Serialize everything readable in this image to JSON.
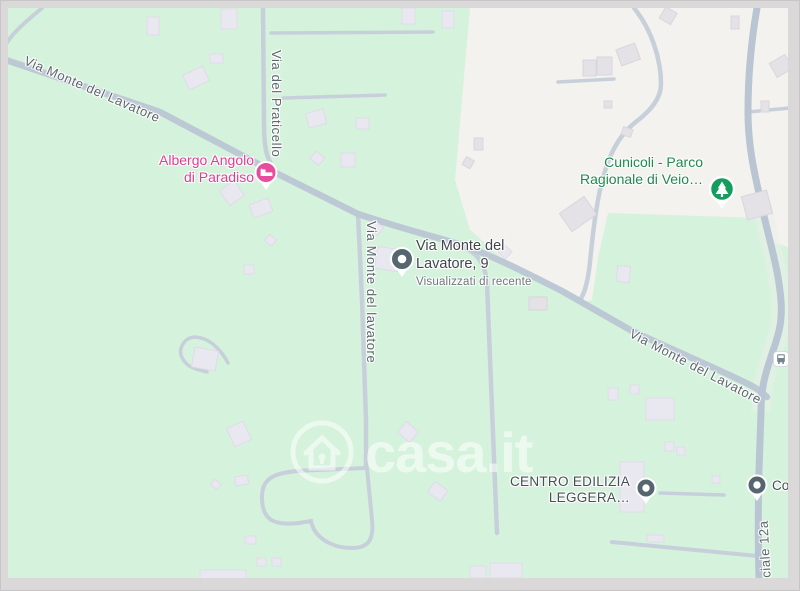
{
  "map": {
    "streets": {
      "main_nw": "Via Monte del Lavatore",
      "praticello": "Via del Praticello",
      "lavatore_vertical": "Via Monte del lavatore",
      "main_se": "Via Monte del Lavatore",
      "provinciale": "nciale 12a"
    },
    "pois": {
      "albergo": {
        "line1": "Albergo Angolo",
        "line2": "di Paradiso"
      },
      "cunicoli": {
        "line1": "Cunicoli - Parco",
        "line2": "Ragionale di Veio…"
      },
      "recent": {
        "line1": "Via Monte del",
        "line2": "Lavatore, 9",
        "note": "Visualizzati di recente"
      },
      "centro": {
        "line1": "CENTRO EDILIZIA",
        "line2": "LEGGERA…"
      },
      "cour": {
        "label": "Cour"
      }
    },
    "watermark": {
      "brand": "casa.it"
    },
    "icons": {
      "hotel": "bed-icon",
      "park": "tree-icon",
      "recent": "recent-dot-pin-icon",
      "generic": "dot-pin-icon",
      "transit": "bus-stop-icon",
      "watermark": "house-keyhole-icon"
    },
    "colors": {
      "land_green": "#d5f2dc",
      "land_white": "#f3f2ee",
      "road": "#c7d0da",
      "road_major": "#bdc8d5",
      "building": "#e9e7f0",
      "frame_gray": "#dad8d8",
      "hotel_pink": "#ea4c9d",
      "park_green": "#149e5d",
      "pin_slate": "#56666f",
      "hotel_text": "#e23d92",
      "park_text": "#1f8a4d",
      "street_text": "#5d666d",
      "poi_text_dark": "#3f464c"
    }
  }
}
